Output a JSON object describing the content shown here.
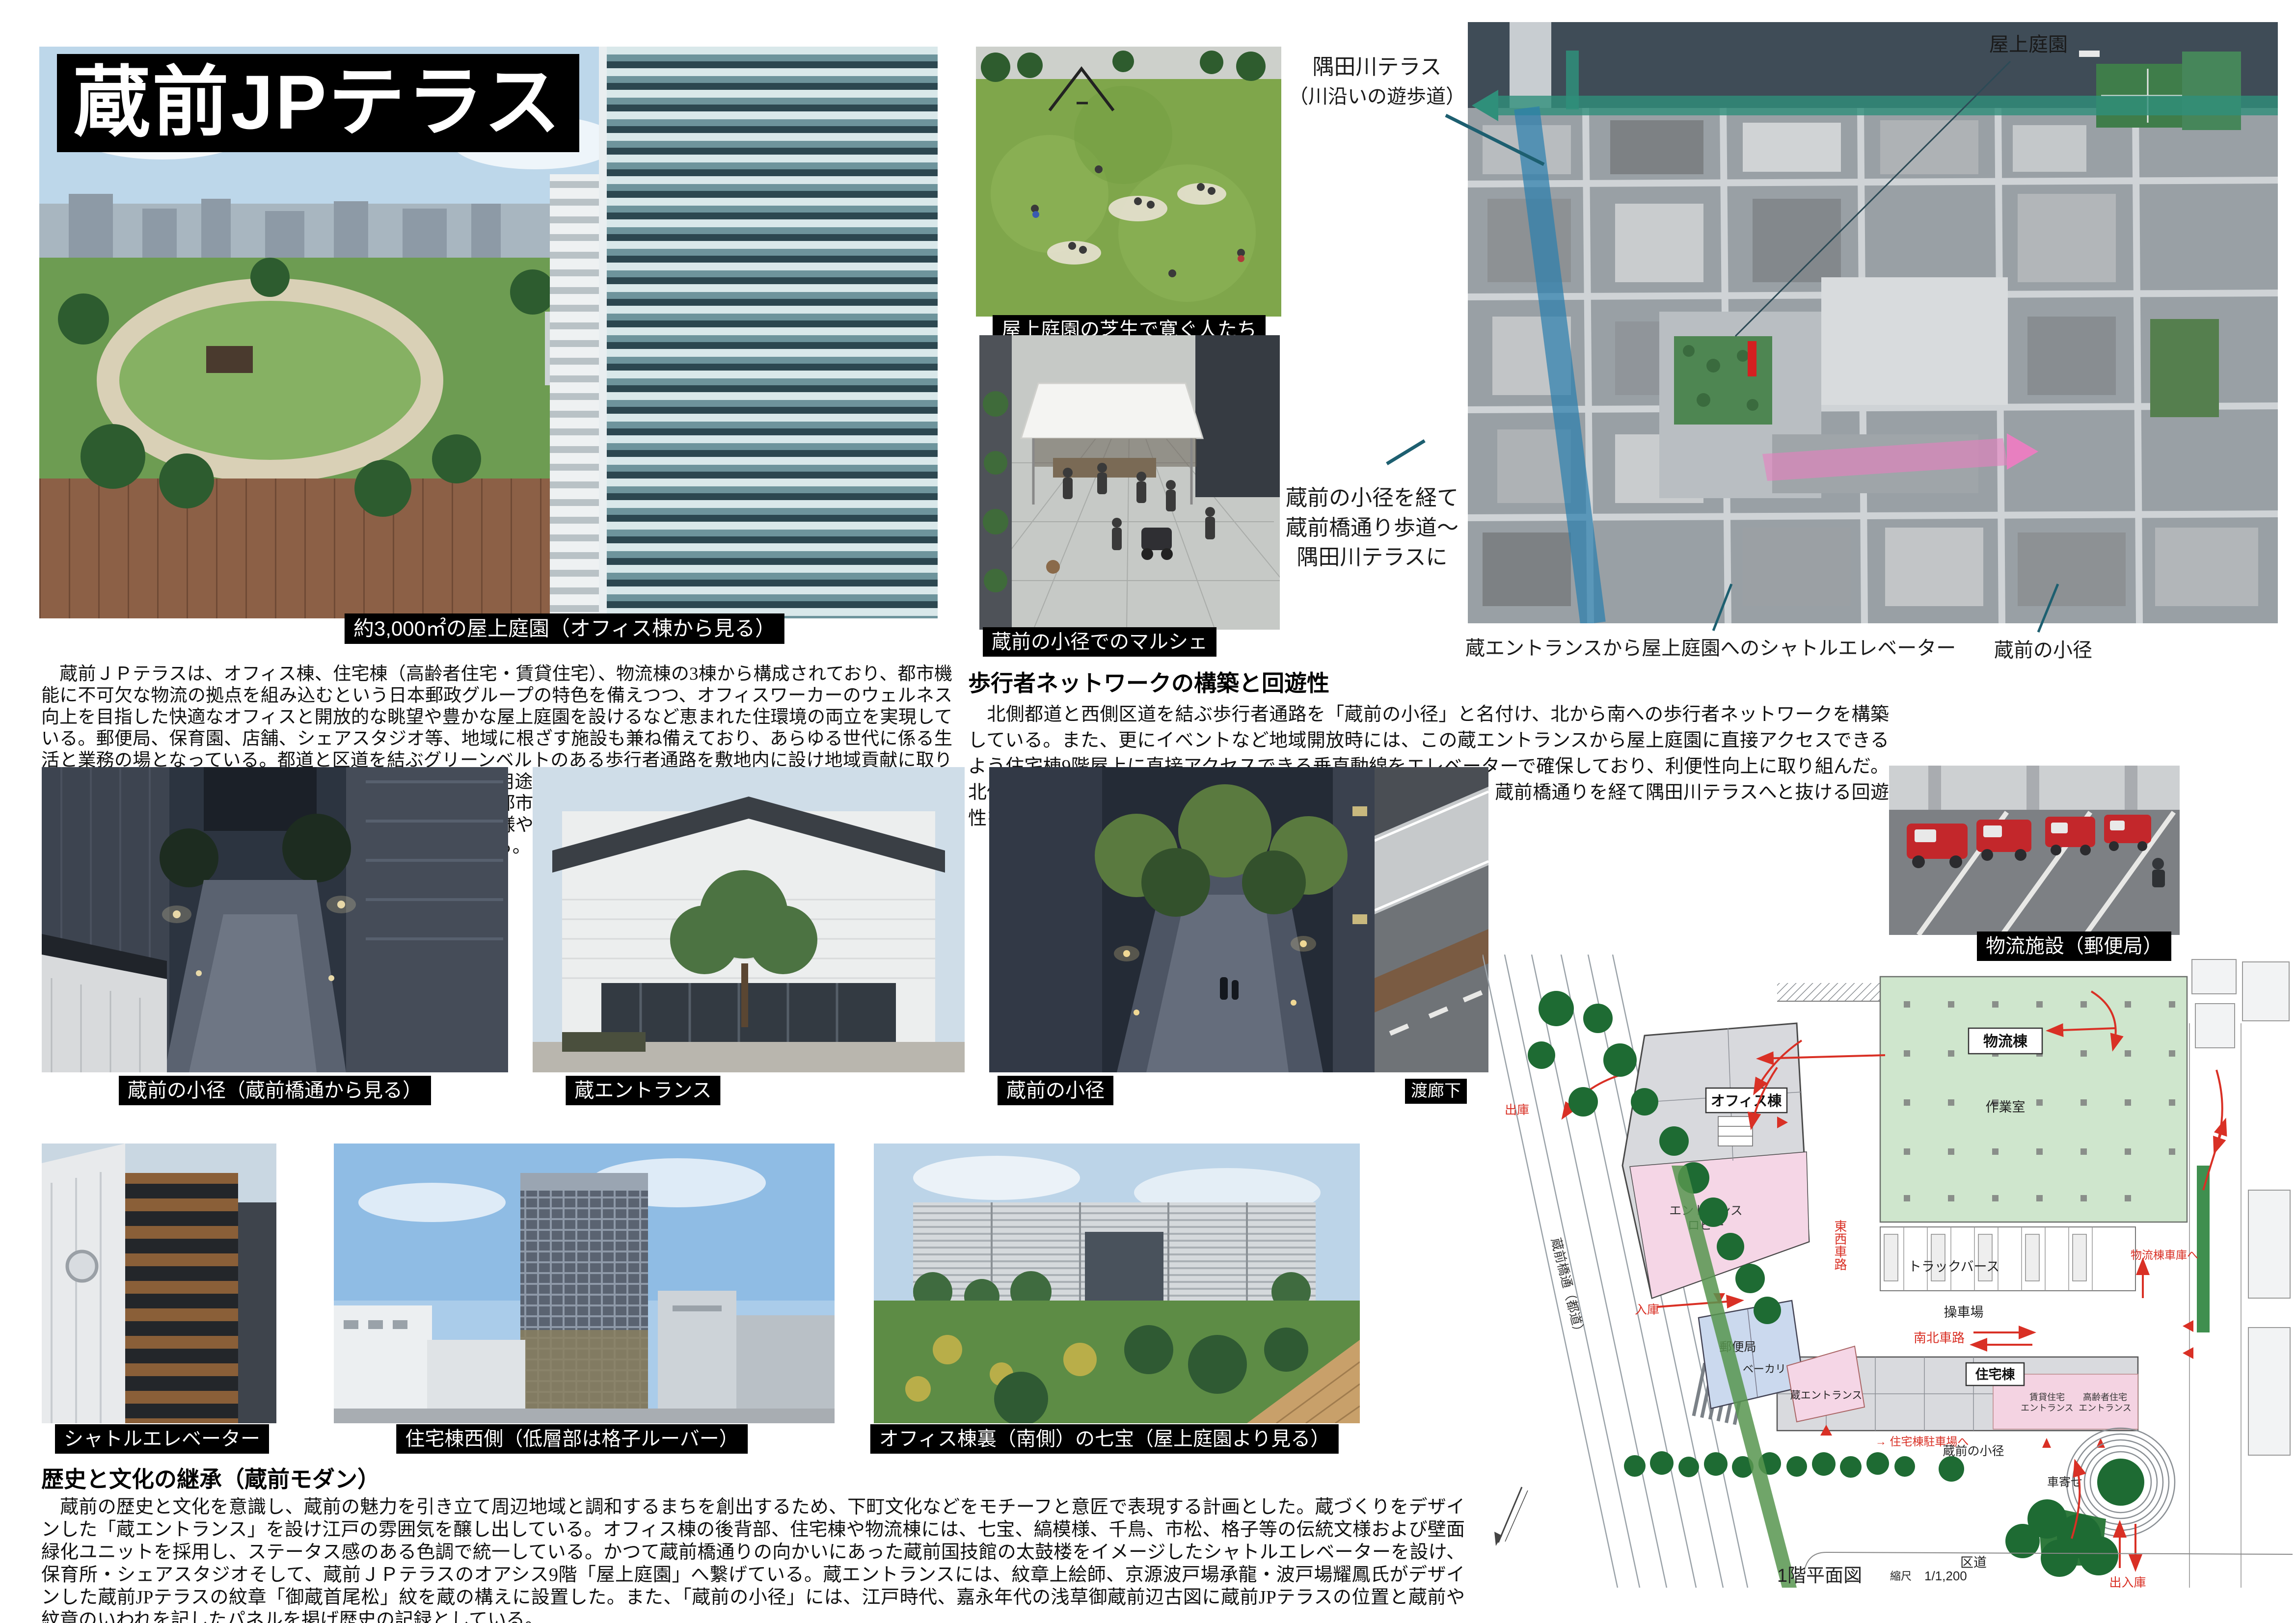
{
  "title": "蔵前JPテラス",
  "intro": {
    "body": "　蔵前ＪＰテラスは、オフィス棟、住宅棟（高齢者住宅・賃貸住宅）、物流棟の3棟から構成されており、都市機能に不可欠な物流の拠点を組み込むという日本郵政グループの特色を備えつつ、オフィスワーカーのウェルネス向上を目指した快適なオフィスと開放的な眺望や豊かな屋上庭園を設けるなど恵まれた住環境の両立を実現している。郵便局、保育園、店舗、シェアスタジオ等、地域に根ざす施設も兼ね備えており、あらゆる世代に係る生活と業務の場となっている。都道と区道を結ぶグリーンベルトのある歩行者通路を敷地内に設け地域貢献に取り組んだ。建物は分節によるボリューム軽減を図り複雑な用途・機能の組み合せを考慮した計画としている。外観は、北側を街並みを映し出すガラスカーテンウォールで都市的なイメージとし、他の部分は蔵前の歴史・文化を連想させる七宝、縞模様、千鳥、市松、格子等の伝統模様や瓦なども採用し、粋な和のテイストを表現した「蔵前モダン」として地域に溶けこむデザインを創出している。"
  },
  "pedestrian": {
    "heading": "歩行者ネットワークの構築と回遊性",
    "body": "　北側都道と西側区道を結ぶ歩行者通路を「蔵前の小径」と名付け、北から南への歩行者ネットワークを構築している。また、更にイベントなど地域開放時には、この蔵エントランスから屋上庭園に直接アクセスできるよう住宅棟9階屋上に直接アクセスできる垂直動線をエレベーターで確保しており、利便性向上に取り組んだ。北側オフィス棟はセットバックし歩道状空地を設けここから、蔵前橋通りを経て隅田川テラスへと抜ける回遊性を確保につなげている。"
  },
  "history": {
    "heading": "歴史と文化の継承（蔵前モダン）",
    "body": "　蔵前の歴史と文化を意識し、蔵前の魅力を引き立て周辺地域と調和するまちを創出するため、下町文化などをモチーフと意匠で表現する計画とした。蔵づくりをデザインした「蔵エントランス」を設け江戸の雰囲気を醸し出している。オフィス棟の後背部、住宅棟や物流棟には、七宝、縞模様、千鳥、市松、格子等の伝統文様および壁面緑化ユニットを採用し、ステータス感のある色調で統一している。かつて蔵前橋通りの向かいにあった蔵前国技館の太鼓楼をイメージしたシャトルエレベーターを設け、保育所・シェアスタジオそして、蔵前ＪＰテラスのオアシス9階「屋上庭園」へ繋げている。蔵エントランスには、紋章上絵師、京源波戸場承龍・波戸場耀鳳氏がデザインした蔵前JPテラスの紋章「御蔵首尾松」紋を蔵の構えに設置した。また、「蔵前の小径」には、江戸時代、嘉永年代の浅草御蔵前辺古図に蔵前JPテラスの位置と蔵前や紋章のいわれを記したパネルを掲げ歴史の記録としている。"
  },
  "photos": {
    "main": "約3,000㎡の屋上庭園（オフィス棟から見る）",
    "lawn": "屋上庭園の芝生で寛ぐ人たち",
    "marche": "蔵前の小径でのマルシェ",
    "alley": "蔵前の小径（蔵前橋通から見る）",
    "kura_entrance": "蔵エントランス",
    "path": "蔵前の小径",
    "corridor": "渡廊下",
    "logistics": "物流施設（郵便局）",
    "shuttle": "シャトルエレベーター",
    "residence_west": "住宅棟西側（低層部は格子ルーバー）",
    "office_back": "オフィス棟裏（南側）の七宝（屋上庭園より見る）"
  },
  "aerial": {
    "sumida_line1": "隅田川テラス",
    "sumida_line2": "（川沿いの遊歩道）",
    "rooftop_garden": "屋上庭園",
    "route_line1": "蔵前の小径を経て",
    "route_line2": "蔵前橋通り歩道〜",
    "route_line3": "隅田川テラスに",
    "shuttle_note": "蔵エントランスから屋上庭園へのシャトルエレベーター",
    "komichi_note": "蔵前の小径"
  },
  "siteplan": {
    "labels": {
      "logistics": "物流棟",
      "workroom": "作業室",
      "truck_berth": "トラックバース",
      "yard": "操車場",
      "ns_road": "南北車路",
      "ew_road": "東西車路",
      "residence": "住宅棟",
      "rental_entrance_1": "賃貸住宅",
      "rental_entrance_2": "エントランス",
      "senior_entrance_1": "高齢者住宅",
      "senior_entrance_2": "エントランス",
      "komichi": "蔵前の小径",
      "porch": "車寄せ",
      "ward_road": "区道",
      "in_out": "出入庫",
      "to_residence_parking": "→ 住宅棟駐車場へ",
      "to_logistics_garage": "物流棟車庫へ",
      "office": "オフィス棟",
      "entrance_lobby_1": "エントランス",
      "entrance_lobby_2": "ロビー",
      "post_office": "郵便局",
      "bakery": "ベーカリー",
      "kura_entrance": "蔵エントランス",
      "street": "蔵前橋通（都道）",
      "exit": "出庫",
      "enter": "入庫"
    },
    "caption": {
      "title": "1階平面図",
      "scale_label": "縮尺",
      "scale_value": "1/1,200"
    }
  }
}
